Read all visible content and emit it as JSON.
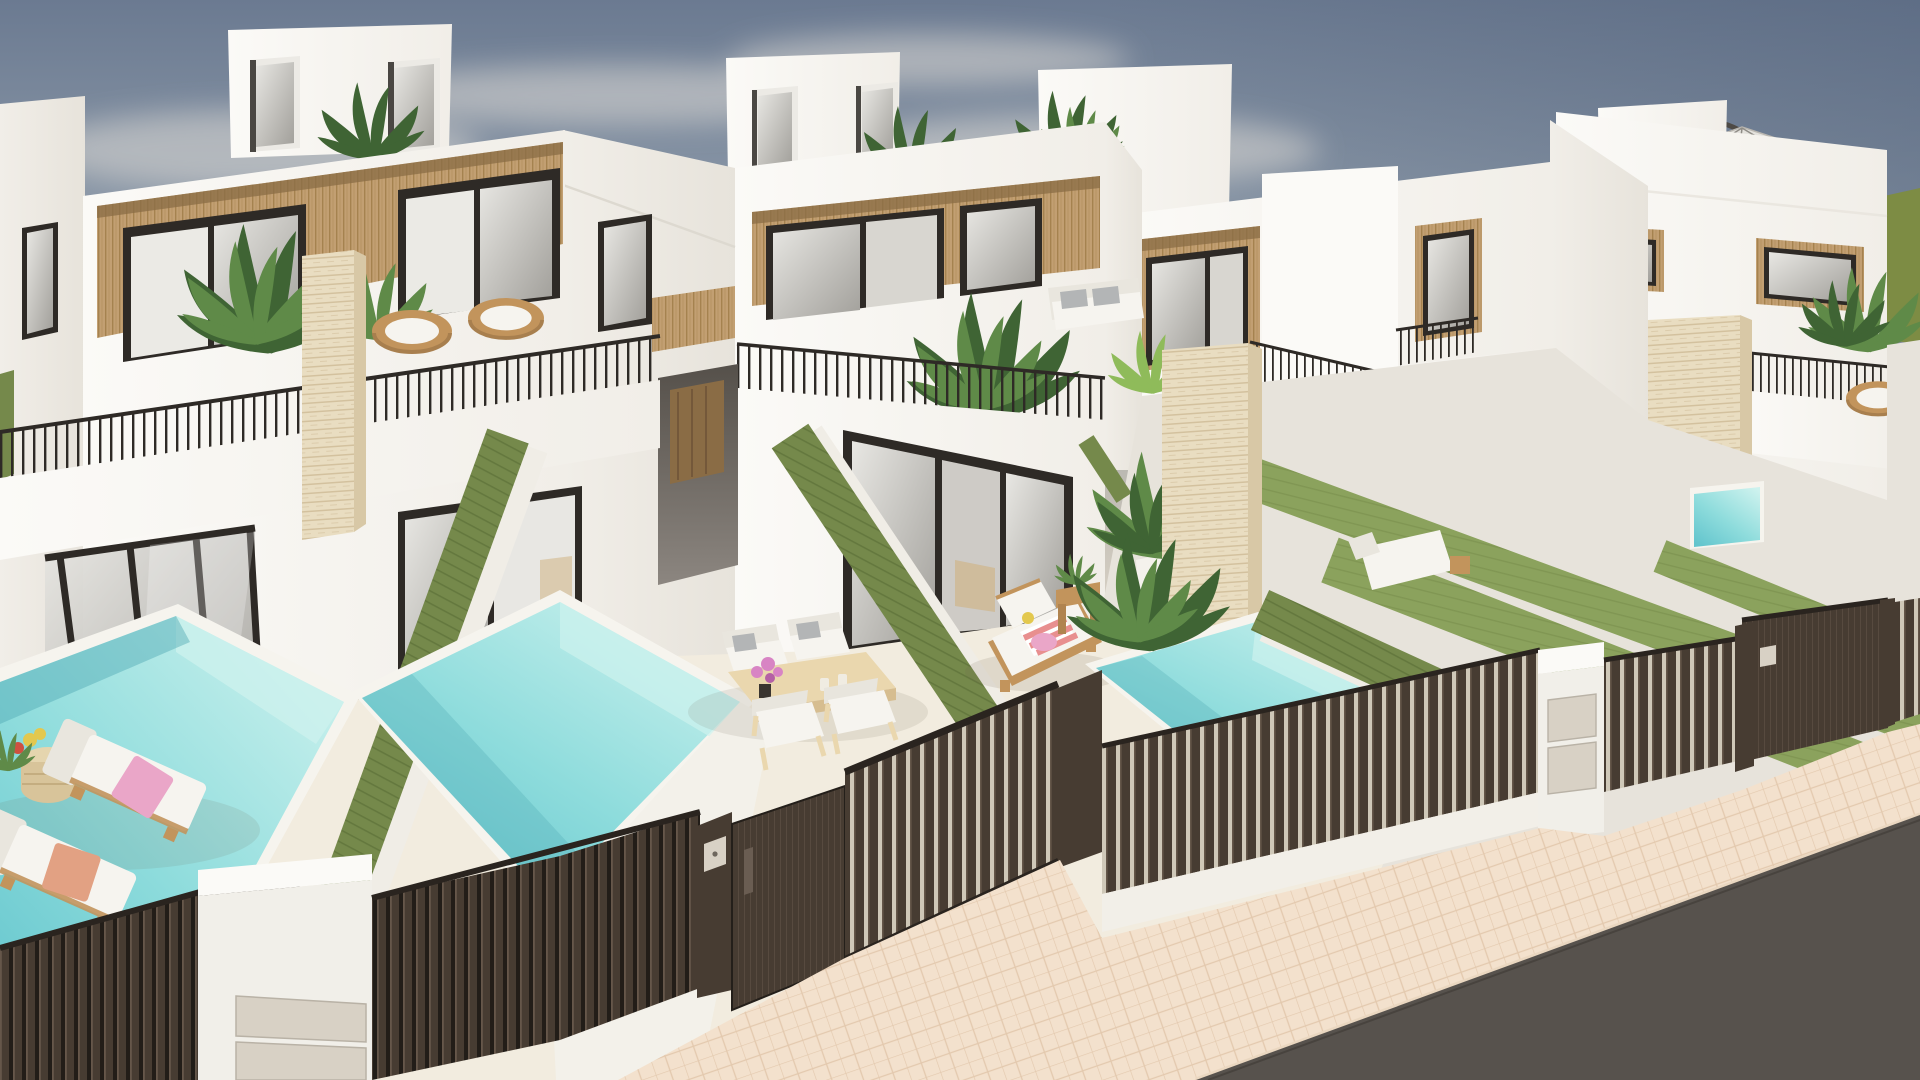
{
  "meta": {
    "width": 1920,
    "height": 1080
  },
  "scene": {
    "type": "architectural-3d-render",
    "subject": "Row of modern white townhouses with wood-slat accents, private patios, turquoise plunge pools, green privacy hedges and dark slatted street fences",
    "elements": [
      "sky",
      "clouds",
      "green-field-horizon",
      "townhouse-left",
      "townhouse-middle",
      "townhouse-right",
      "townhouse-far-right",
      "rooftop-stair-boxes",
      "roof-terrace-parasol",
      "wood-slat-facade-panels",
      "dark-framed-glass-doors",
      "balcony-railings",
      "travertine-pillars",
      "terrace-plants",
      "rattan-chairs",
      "privacy-hedge-walls",
      "lawn-strips",
      "pool-left-neighbor",
      "pool-left",
      "pool-middle",
      "pool-right-glimpse",
      "patio-dining-set",
      "sun-loungers",
      "chaise-lounge",
      "side-tables",
      "potted-plants",
      "entry-gate-center",
      "entry-gate-right",
      "slatted-fences",
      "white-gate-pillars",
      "gate-keypads",
      "paver-sidewalk",
      "asphalt-road"
    ]
  },
  "colors": {
    "sky_top": "#6b7a91",
    "sky_mid": "#8d9aa9",
    "sky_low": "#b3b2ac",
    "sky_horizon": "#d6cfc3",
    "sky_tint": "#4a5a74",
    "cloud": "#dcd9d4",
    "field": "#7d8c44",
    "wall_lit": "#fbfaf7",
    "wall": "#f1eee8",
    "wall_shade": "#e7e3db",
    "wall_dim": "#d8d3ca",
    "wood": "#c29f72",
    "wood_stripe": "#a5824f",
    "wood_shadow": "#8a6c45",
    "frame_dark": "#2e2a26",
    "glass_light": "#e8e7e3",
    "glass_dark": "#a19f9a",
    "curtain": "#f6f4ef",
    "trav": "#e9ddc1",
    "trav_line": "#d3c19e",
    "trav_shade": "#d8c8a6",
    "hedge": "#75894b",
    "hedge_line": "#64783e",
    "lawn": "#8ba25d",
    "lawn_line": "#7d9450",
    "pool_light": "#cdf2ee",
    "pool_mid": "#8edcdc",
    "pool_deep": "#63c5cd",
    "pool_shadow": "#4fa9b4",
    "patio": "#f2ecdf",
    "coping": "#f6f4ee",
    "fence": "#473c32",
    "fence_light": "#6b5c4f",
    "fence_gap": "#221d18",
    "gate_gap": "#cfc8b8",
    "metal": "#d8d1c5",
    "sidewalk": "#f3e1cd",
    "sidewalk_line": "#e3c9ae",
    "curb": "#ead7c0",
    "asphalt": "#57524d",
    "furn_wood": "#c2945c",
    "furn_wood_light": "#ead7ae",
    "cushion": "#f6f4ef",
    "cushion_shade": "#e9e6de",
    "pillow_gray": "#b3b5b6",
    "towel_pink": "#eaa6c8",
    "towel_coral": "#e88f8f",
    "towel_orange": "#e2a183",
    "flower_pink": "#d884c4",
    "flower_red": "#cf5040",
    "flower_yellow": "#e3c84e",
    "plant": "#5f8a48",
    "plant_dark": "#3f6434",
    "plant_light": "#8fbb5a",
    "pot_white": "#f4f2ec",
    "umbrella": "#e4e2dd",
    "umbrella_dark": "#4e4a45"
  }
}
